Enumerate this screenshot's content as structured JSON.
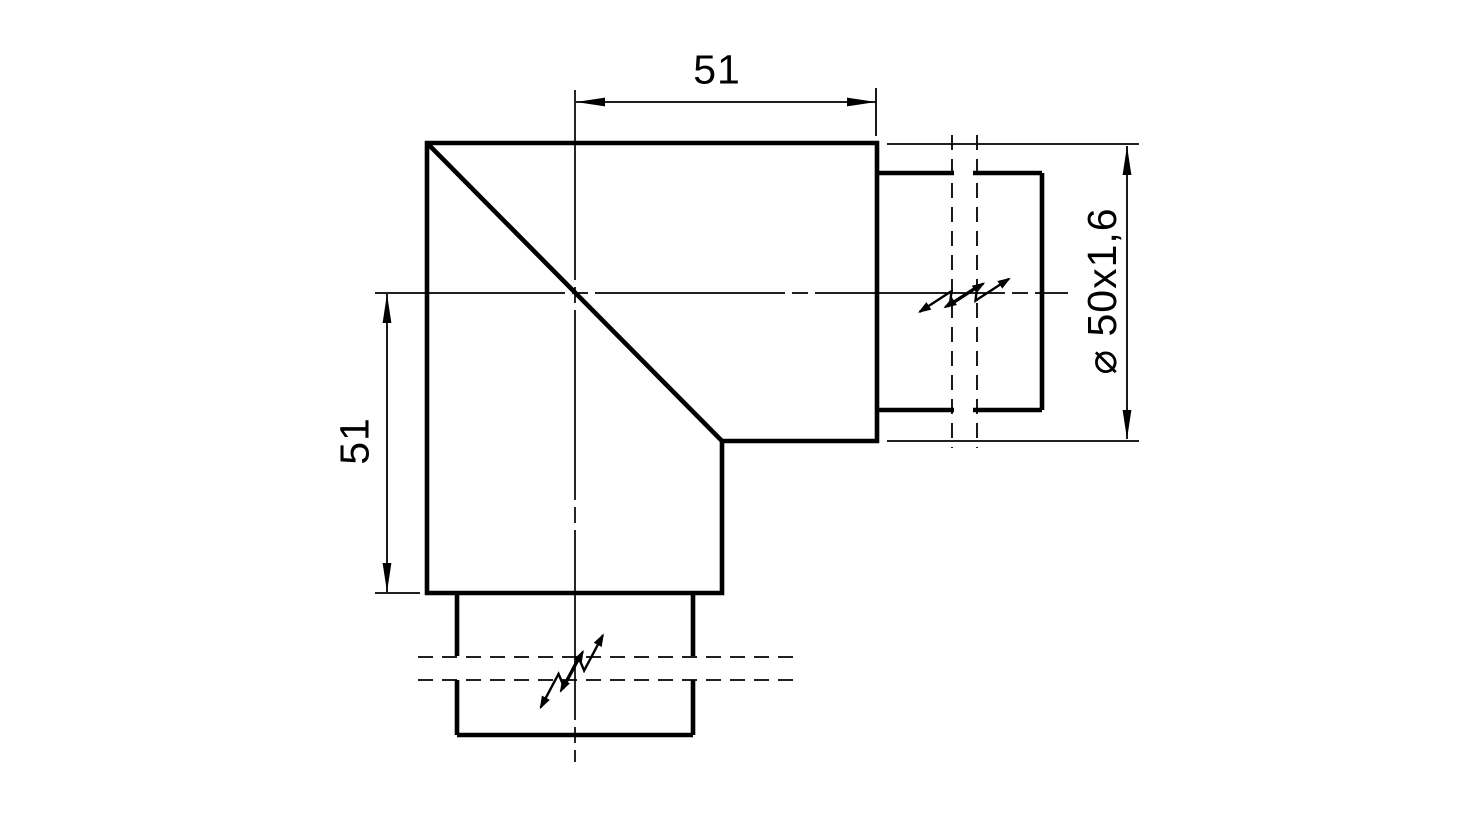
{
  "canvas": {
    "background_color": "#ffffff",
    "line_color": "#000000"
  },
  "dimensions": {
    "top_width": {
      "label": "51"
    },
    "left_height": {
      "label": "51"
    },
    "pipe_diameter": {
      "label": "⌀ 50x1,6"
    }
  }
}
